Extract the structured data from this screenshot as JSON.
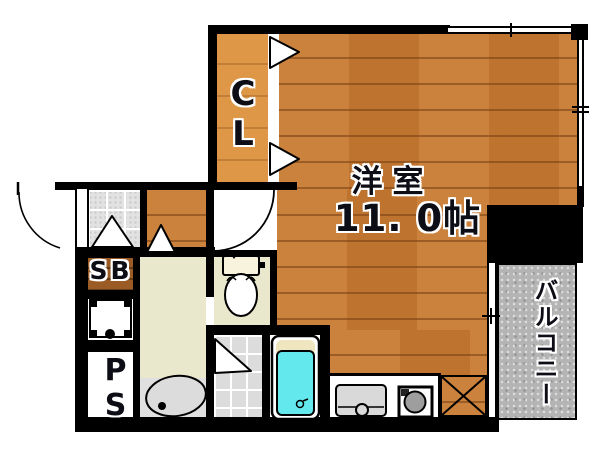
{
  "plan": {
    "rooms": {
      "main_room": {
        "name": "洋室",
        "size": "11. 0帖"
      },
      "closet_label": "CL",
      "shoe_box_label": "SB",
      "pipe_space_label": "PS",
      "balcony_label": "バルコニー"
    },
    "colors": {
      "wood_floor": "#c87a30",
      "closet_wood": "#dd9747",
      "shoe_box_wood": "#9a5c24",
      "wall": "#000000",
      "washroom_floor": "#eae8cc",
      "tile_floor": "#dcdcdc",
      "balcony": "#b4b4b4",
      "bathtub": "#63e9ed",
      "bathtub_rim": "#efe5be",
      "fixture_gray": "#d9d9d9"
    }
  }
}
